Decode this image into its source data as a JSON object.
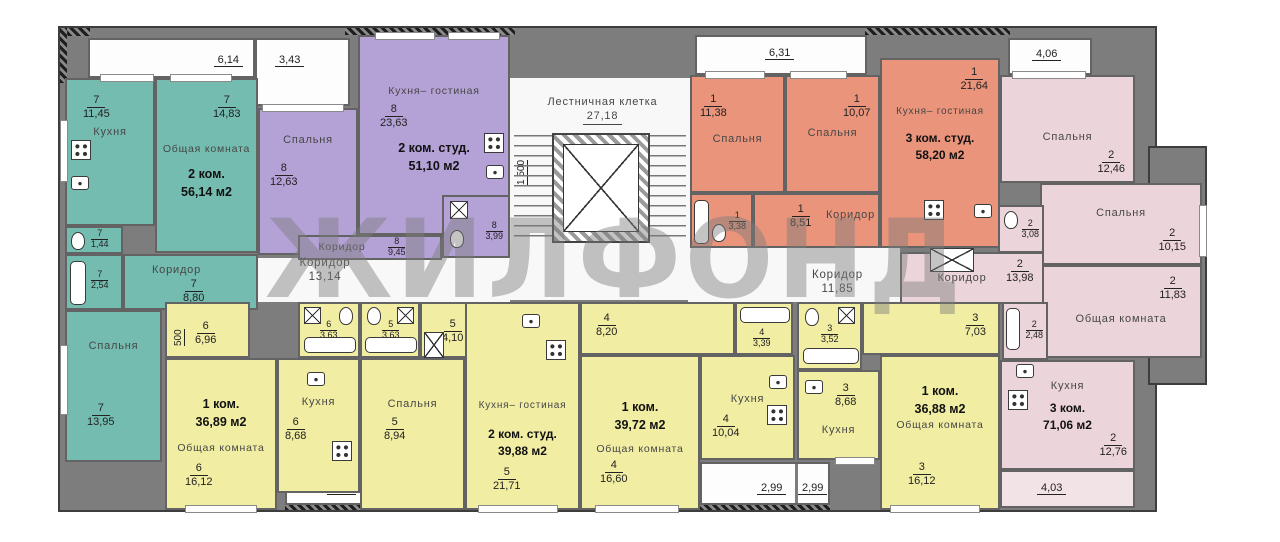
{
  "watermark": "ЖИЛФОНД",
  "colors": {
    "teal": "#74bcb0",
    "purple": "#b4a1d6",
    "orange": "#e9947b",
    "pink": "#ecd5da",
    "yellow": "#f1eda3",
    "wall": "#7d7d7d"
  },
  "staircase": {
    "name": "Лестничная клетка",
    "area": "27,18",
    "dim_vertical": "1 500"
  },
  "corridors": {
    "left": {
      "name": "Коридор",
      "area": "13,14"
    },
    "right": {
      "name": "Коридор",
      "area": "11,85"
    }
  },
  "dims": {
    "teal_top": "6,14",
    "purple_top": "3,43",
    "orange_top": "6,31",
    "pink_top": "4,06",
    "pink_bottom": "4,03",
    "y6_vertical": "500"
  },
  "balconies": {
    "a1": "2,99",
    "a2": "2,99",
    "b1": "2,99",
    "b2": "2,99"
  },
  "apartments": [
    {
      "key": "teal",
      "flat": "2 ком.",
      "total": "56,14 м2",
      "rooms": {
        "kitchen": {
          "name": "Кухня",
          "num": "7",
          "area": "11,45"
        },
        "living": {
          "name": "Общая комната",
          "num": "7",
          "area": "14,83"
        },
        "wc": {
          "num": "7",
          "area": "1,44"
        },
        "bath": {
          "num": "7",
          "area": "2,54"
        },
        "corridor": {
          "name": "Коридор",
          "num": "7",
          "area": "8,80"
        },
        "bedroom": {
          "name": "Спальня",
          "num": "7",
          "area": "13,95"
        }
      }
    },
    {
      "key": "purple",
      "flat": "2 ком. студ.",
      "total": "51,10 м2",
      "rooms": {
        "bedroom": {
          "name": "Спальня",
          "num": "8",
          "area": "12,63"
        },
        "kitchen_living": {
          "name": "Кухня– гостиная",
          "num": "8",
          "area": "23,63"
        },
        "corridor": {
          "name": "Коридор",
          "num": "8",
          "area": "9,45"
        },
        "bath": {
          "num": "8",
          "area": "3,99"
        }
      }
    },
    {
      "key": "orange",
      "flat": "3 ком. студ.",
      "total": "58,20 м2",
      "rooms": {
        "bedroom1": {
          "name": "Спальня",
          "num": "1",
          "area": "11,38"
        },
        "bedroom2": {
          "name": "Спальня",
          "num": "1",
          "area": "10,07"
        },
        "kitchen_living": {
          "name": "Кухня– гостиная",
          "num": "1",
          "area": "21,64"
        },
        "corridor": {
          "name": "Коридор",
          "num": "1",
          "area": "8,51"
        },
        "bath": {
          "num": "1",
          "area": "3,38"
        }
      }
    },
    {
      "key": "pink",
      "flat": "3 ком.",
      "total": "71,06 м2",
      "rooms": {
        "bedroom1": {
          "name": "Спальня",
          "num": "2",
          "area": "12,46"
        },
        "bedroom2": {
          "name": "Спальня",
          "num": "2",
          "area": "10,15"
        },
        "living": {
          "name": "Общая комната",
          "num": "2",
          "area": "11,83"
        },
        "wc": {
          "num": "2",
          "area": "3,08"
        },
        "corridor": {
          "name": "Коридор",
          "num": "2",
          "area": "13,98"
        },
        "bath": {
          "num": "2",
          "area": "2,48"
        },
        "kitchen": {
          "name": "Кухня",
          "num": "2",
          "area": "12,76"
        }
      }
    },
    {
      "key": "y6",
      "flat": "1 ком.",
      "total": "36,89 м2",
      "rooms": {
        "hall": {
          "num": "6",
          "area": "6,96"
        },
        "bath": {
          "num": "6",
          "area": "3,63"
        },
        "living": {
          "name": "Общая комната",
          "num": "6",
          "area": "16,12"
        },
        "kitchen": {
          "name": "Кухня",
          "num": "6",
          "area": "8,68"
        }
      }
    },
    {
      "key": "y5",
      "flat": "2 ком. студ.",
      "total": "39,88 м2",
      "rooms": {
        "bath": {
          "num": "5",
          "area": "3,63"
        },
        "hall": {
          "num": "5",
          "area": "4,10"
        },
        "bedroom": {
          "name": "Спальня",
          "num": "5",
          "area": "8,94"
        },
        "kitchen_living": {
          "name": "Кухня– гостиная",
          "num": "5",
          "area": "21,71"
        }
      }
    },
    {
      "key": "y4",
      "flat": "1 ком.",
      "total": "39,72 м2",
      "rooms": {
        "hall": {
          "num": "4",
          "area": "8,20"
        },
        "living": {
          "name": "Общая комната",
          "num": "4",
          "area": "16,60"
        },
        "kitchen": {
          "name": "Кухня",
          "num": "4",
          "area": "10,04"
        },
        "bath": {
          "num": "4",
          "area": "3,39"
        }
      }
    },
    {
      "key": "y3",
      "flat": "1 ком.",
      "total": "36,88 м2",
      "rooms": {
        "bath": {
          "num": "3",
          "area": "3,52"
        },
        "kitchen": {
          "name": "Кухня",
          "num": "3",
          "area": "8,68"
        },
        "hall": {
          "num": "3",
          "area": "7,03"
        },
        "living": {
          "name": "Общая комната",
          "num": "3",
          "area": "16,12"
        }
      }
    }
  ],
  "icons": {
    "bathtub": "css-rounded-rect",
    "stove": "css-burner-dots",
    "toilet": "css-oval",
    "sink": "css-rect-dot",
    "washer": "css-crossed-box",
    "elevator": "css-hatched-crossed-box",
    "stairs": "css-striped-flight"
  }
}
